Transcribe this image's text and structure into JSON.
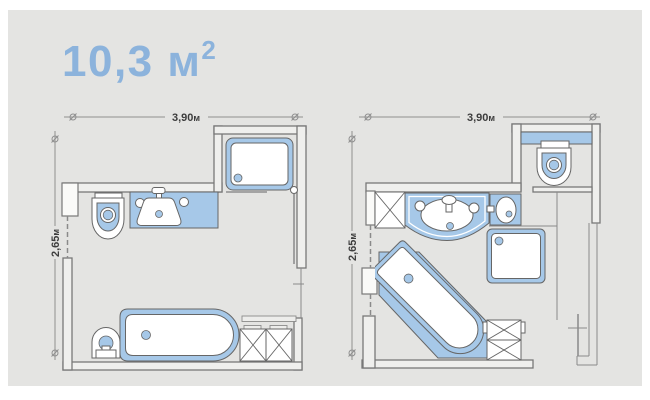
{
  "title": {
    "value": "10,3 м",
    "sup": "2"
  },
  "colors": {
    "accent_blue": "#8cb3dc",
    "fixture_blue": "#a6c8e8",
    "wall_fill": "#efefed",
    "wall_stroke": "#787878",
    "outline": "#666666",
    "panel": "#e4e4e2",
    "dim": "#8f8f8f",
    "text": "#3d3d3d"
  },
  "plans": [
    {
      "id": "plan-left",
      "width": {
        "value": "3,90",
        "unit": "м"
      },
      "height": {
        "value": "2,65",
        "unit": "м"
      },
      "fixtures": [
        "shower-cabin",
        "wall-hung-toilet",
        "vanity-sink",
        "bidet",
        "bathtub",
        "storage-cabinets"
      ]
    },
    {
      "id": "plan-right",
      "width": {
        "value": "3,90",
        "unit": "м"
      },
      "height": {
        "value": "2,65",
        "unit": "м"
      },
      "fixtures": [
        "toilet-compartment",
        "washing-machine",
        "vanity-sink",
        "corner-washbasin",
        "shower-cabin",
        "corner-bathtub",
        "storage-cabinet",
        "towel-rail"
      ]
    }
  ]
}
